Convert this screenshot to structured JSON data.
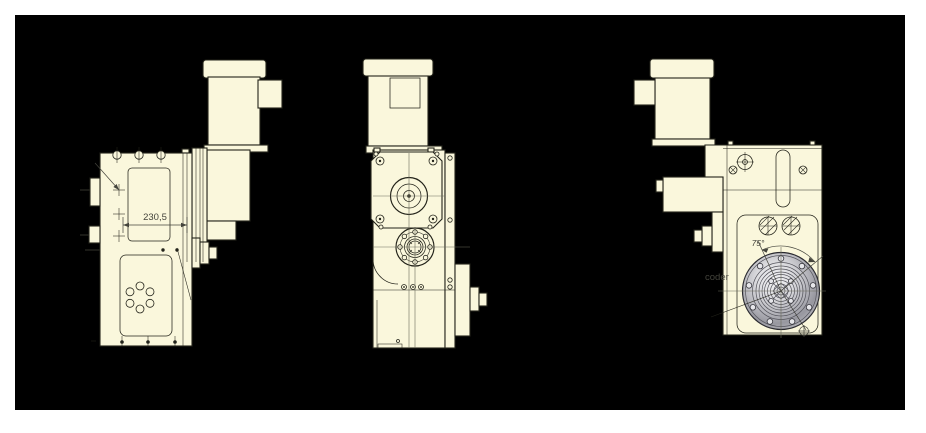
{
  "title": "Geared motor / rotary actuator technical drawing with three orthographic views",
  "colors": {
    "page_background": "#ffffff",
    "canvas_background": "#000000",
    "body_fill": "#faf7dc",
    "outline": "#23231a",
    "centerline": "#6b6b5a",
    "dimension": "#44443c",
    "flange_light": "#f2f2f4",
    "flange_mid": "#b9b9bf",
    "flange_dark": "#8f8f97"
  },
  "views": {
    "left": {
      "name": "left-side-view",
      "dimension_label": "230,5"
    },
    "front": {
      "name": "front-view"
    },
    "right": {
      "name": "right-side-view",
      "angle_label": "75°",
      "text_fragment": "coder"
    }
  }
}
